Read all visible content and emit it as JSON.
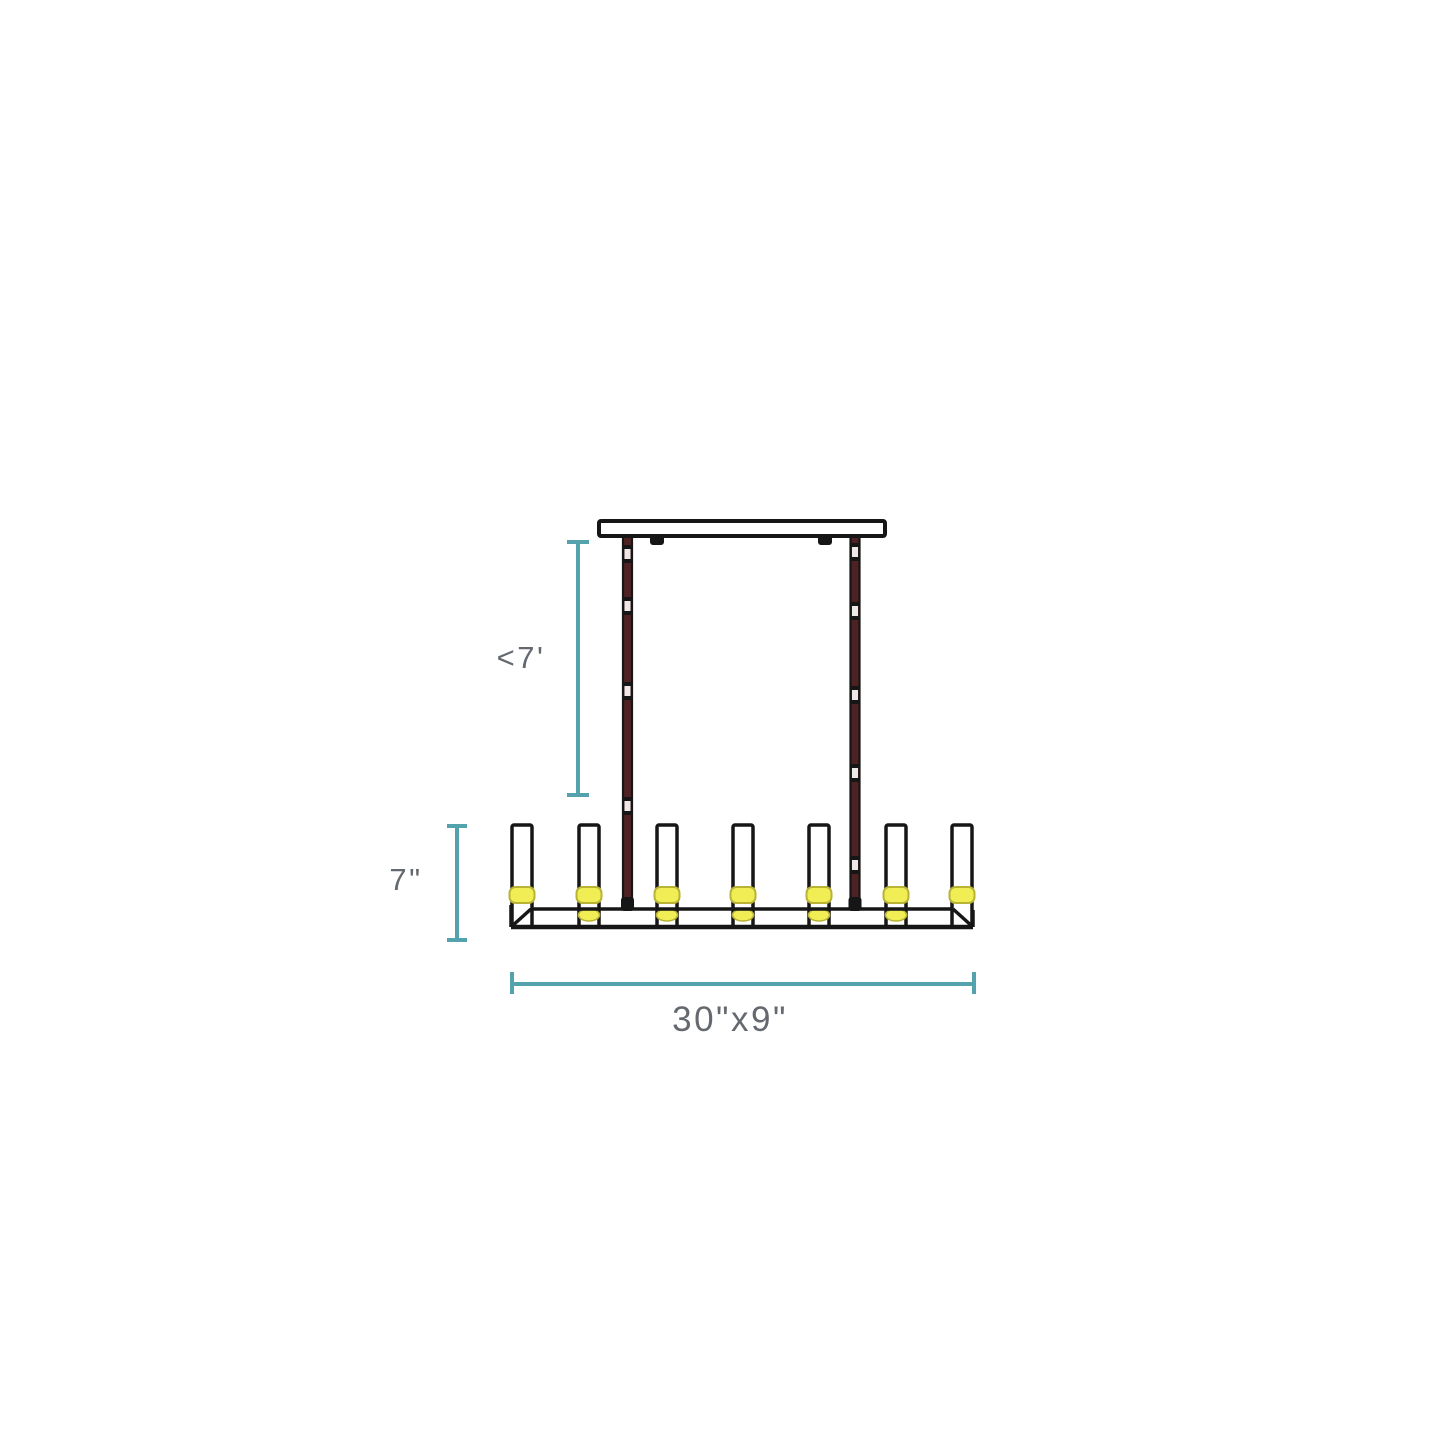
{
  "diagram": {
    "title": "Linear chandelier installation dimension diagram",
    "fixture": {
      "type": "linear chandelier, side elevation",
      "candle_count": 7,
      "rod_count": 2
    },
    "labels": {
      "suspension_max": "<7'",
      "fixture_height": "7\"",
      "fixture_size": "30\"x9\""
    },
    "colors": {
      "dimension": "#54A2AB",
      "text": "#64696F",
      "line": "#161616",
      "rod": "#4E2123",
      "lamp": "#F1EE55",
      "lamp_edge": "#B9B335",
      "background": "#FFFFFF"
    }
  }
}
